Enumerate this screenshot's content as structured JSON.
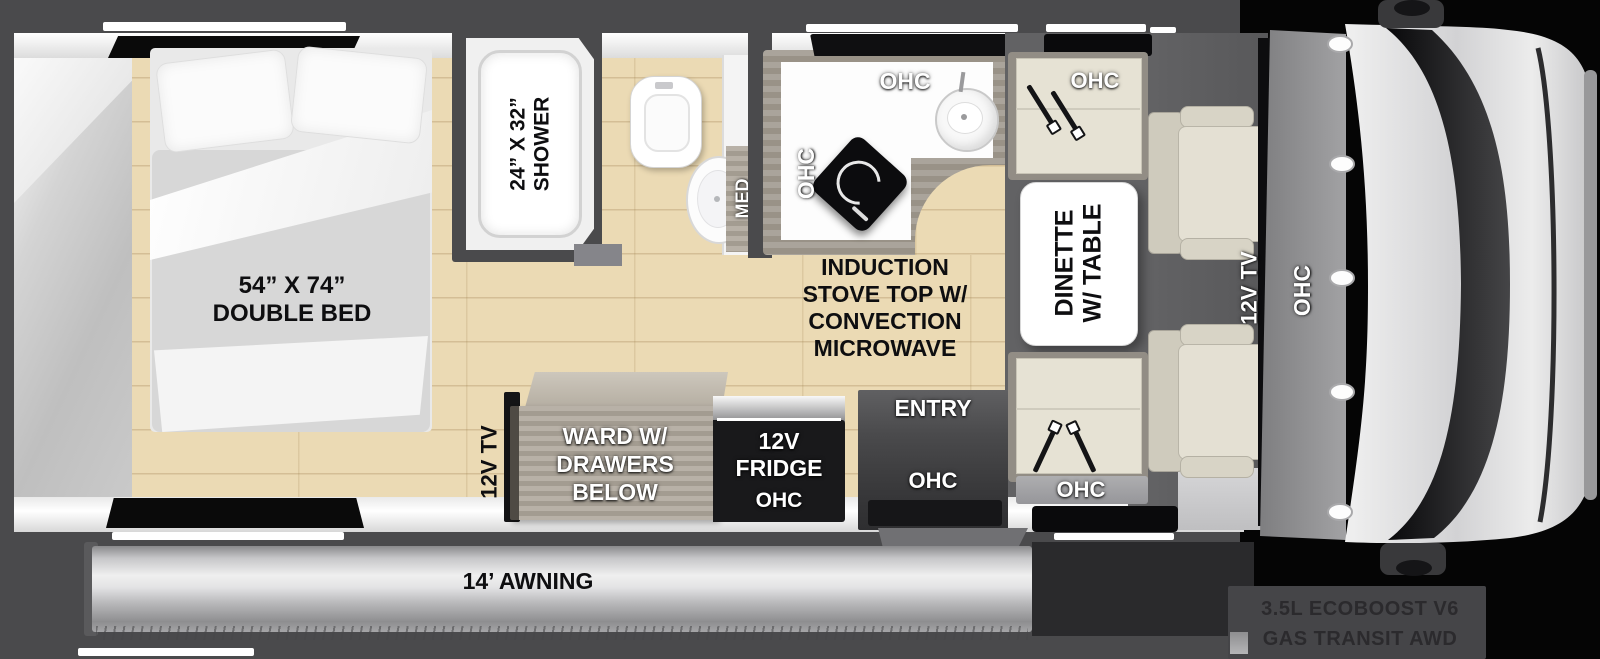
{
  "floorplan": {
    "bedroom": {
      "bed_size": "54” X 74”",
      "bed_type": "DOUBLE BED",
      "tv": "12V TV"
    },
    "bathroom": {
      "shower_size": "24” X 32”",
      "shower": "SHOWER",
      "med": "MED"
    },
    "kitchen": {
      "ohc_top": "OHC",
      "ohc_side": "OHC",
      "stove_line1": "INDUCTION",
      "stove_line2": "STOVE TOP W/",
      "stove_line3": "CONVECTION",
      "stove_line4": "MICROWAVE"
    },
    "dinette": {
      "ohc_front": "OHC",
      "ohc_rear": "OHC",
      "table_line1": "DINETTE",
      "table_line2": "W/ TABLE"
    },
    "storage": {
      "ward_line1": "WARD W/",
      "ward_line2": "DRAWERS",
      "ward_line3": "BELOW",
      "fridge_line1": "12V",
      "fridge_line2": "FRIDGE",
      "fridge_ohc": "OHC"
    },
    "entry": {
      "label": "ENTRY",
      "ohc": "OHC"
    },
    "cab": {
      "tv": "12V TV",
      "ohc": "OHC",
      "chassis_line1": "3.5L ECOBOOST V6",
      "chassis_line2": "GAS TRANSIT AWD"
    },
    "exterior": {
      "awning": "14’ AWNING"
    }
  },
  "colors": {
    "wall_dark": "#4a4a4c",
    "floor_wood": "#ebdab4",
    "appliance_black": "#19191b",
    "awning_silver": "#d9d9d9",
    "seat_cream": "#e6e2d4"
  }
}
